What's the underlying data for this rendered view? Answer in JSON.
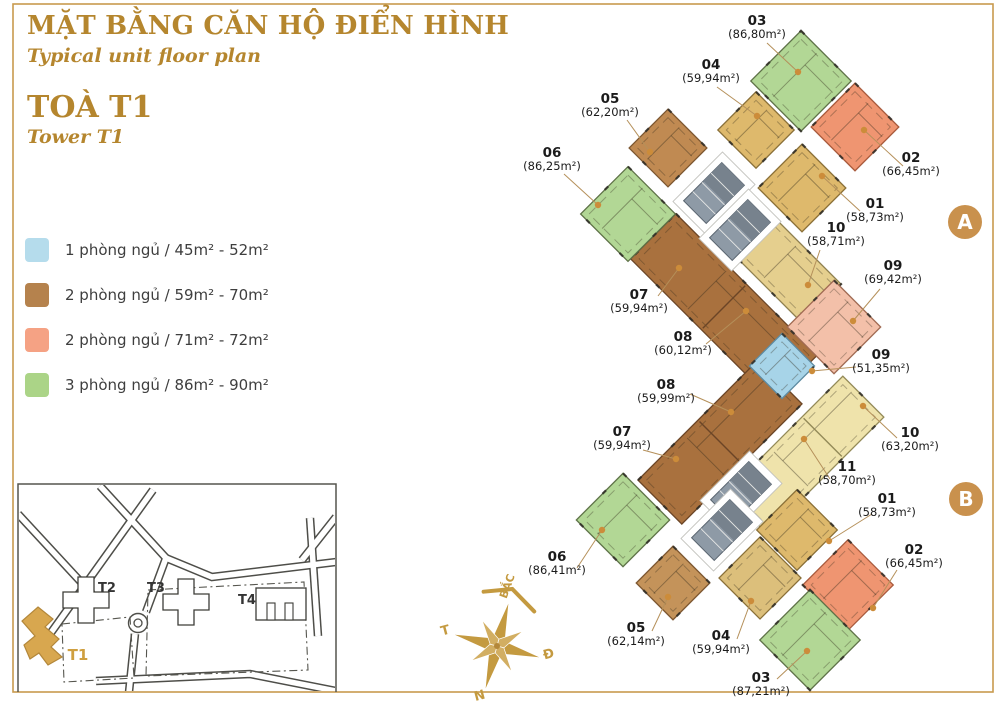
{
  "page": {
    "background": "#ffffff",
    "border_color": "#c89a4e"
  },
  "header": {
    "title_vi": "MẶT BẰNG CĂN HỘ ĐIỂN HÌNH",
    "title_en": "Typical unit floor plan",
    "tower_vi": "TOÀ T1",
    "tower_en": "Tower T1",
    "accent_color": "#b5862e"
  },
  "legend": {
    "items": [
      {
        "color": "#b5dcec",
        "label": "1 phòng ngủ / 45m² - 52m²"
      },
      {
        "color": "#b5824d",
        "label": "2 phòng ngủ / 59m² - 70m²"
      },
      {
        "color": "#f5a284",
        "label": "2 phòng ngủ / 71m² - 72m²"
      },
      {
        "color": "#abd487",
        "label": "3 phòng ngủ / 86m² - 90m²"
      }
    ]
  },
  "site_map": {
    "buildings": [
      {
        "id": "T1",
        "x": 78,
        "y": 660,
        "color": "#cf9f3f",
        "highlight": true
      },
      {
        "id": "T2",
        "x": 107,
        "y": 592,
        "color": "#343434",
        "highlight": false
      },
      {
        "id": "T3",
        "x": 156,
        "y": 592,
        "color": "#343434",
        "highlight": false
      },
      {
        "id": "T4",
        "x": 247,
        "y": 604,
        "color": "#343434",
        "highlight": false
      }
    ]
  },
  "compass": {
    "north": "BẮC",
    "east": "Đ",
    "south": "N",
    "west": "T",
    "color": "#c49a40"
  },
  "plan": {
    "badge_color": "#c9914d",
    "leader_color": "#b5905a",
    "dot_color": "#cc8c3a",
    "badges": [
      {
        "label": "A",
        "x": 965,
        "y": 222
      },
      {
        "label": "B",
        "x": 966,
        "y": 499
      }
    ],
    "shapes": [
      {
        "id": "wing-a-strip-07-08",
        "cx": 724,
        "cy": 307,
        "w": 200,
        "h": 64,
        "rot": 45,
        "fill": "#a9713e",
        "stk": "#6b4526",
        "div": true,
        "divAt": 0
      },
      {
        "id": "wing-b-strip-08-07",
        "cx": 720,
        "cy": 442,
        "w": 170,
        "h": 62,
        "rot": -45,
        "fill": "#a9713e",
        "stk": "#6b4526",
        "div": true,
        "divAt": 0
      },
      {
        "id": "unit-strip-10a",
        "cx": 788,
        "cy": 270,
        "w": 95,
        "h": 55,
        "rot": 45,
        "fill": "#e5cf8e",
        "stk": "#8f8050",
        "div": false,
        "divAt": 0
      },
      {
        "id": "unit-strip-10-11b",
        "cx": 805,
        "cy": 455,
        "w": 165,
        "h": 58,
        "rot": -45,
        "fill": "#efe3ab",
        "stk": "#938a58",
        "div": true,
        "divAt": 25
      },
      {
        "id": "unit-a06",
        "cx": 628,
        "cy": 214,
        "w": 67,
        "h": 67,
        "rot": 45,
        "fill": "#b2d795",
        "stk": "#5e7247",
        "div": false,
        "divAt": 0
      },
      {
        "id": "unit-a05",
        "cx": 668,
        "cy": 148,
        "w": 55,
        "h": 55,
        "rot": 45,
        "fill": "#c08a52",
        "stk": "#7c5630",
        "div": false,
        "divAt": 0
      },
      {
        "id": "unit-a04",
        "cx": 756,
        "cy": 130,
        "w": 54,
        "h": 54,
        "rot": 45,
        "fill": "#deb96c",
        "stk": "#8a7038",
        "div": false,
        "divAt": 0
      },
      {
        "id": "unit-a03",
        "cx": 801,
        "cy": 81,
        "w": 71,
        "h": 71,
        "rot": 45,
        "fill": "#b2d795",
        "stk": "#5e7247",
        "div": false,
        "divAt": 0
      },
      {
        "id": "unit-a02",
        "cx": 855,
        "cy": 127,
        "w": 62,
        "h": 62,
        "rot": 45,
        "fill": "#ef9571",
        "stk": "#a85a3c",
        "div": false,
        "divAt": 0
      },
      {
        "id": "unit-a01",
        "cx": 802,
        "cy": 188,
        "w": 62,
        "h": 62,
        "rot": 45,
        "fill": "#deb96c",
        "stk": "#8a7038",
        "div": false,
        "divAt": 0
      },
      {
        "id": "unit-a09",
        "cx": 834,
        "cy": 327,
        "w": 66,
        "h": 66,
        "rot": 45,
        "fill": "#f3c0a9",
        "stk": "#a06a52",
        "div": false,
        "divAt": 0
      },
      {
        "id": "unit-09-blue",
        "cx": 782,
        "cy": 366,
        "w": 46,
        "h": 46,
        "rot": 45,
        "fill": "#a7d4e8",
        "stk": "#5d8aa0",
        "div": false,
        "divAt": 0
      },
      {
        "id": "unit-b01",
        "cx": 797,
        "cy": 530,
        "w": 57,
        "h": 57,
        "rot": 45,
        "fill": "#deb96c",
        "stk": "#8a7038",
        "div": false,
        "divAt": 0
      },
      {
        "id": "unit-b02",
        "cx": 848,
        "cy": 585,
        "w": 64,
        "h": 64,
        "rot": 45,
        "fill": "#ef9571",
        "stk": "#a85a3c",
        "div": false,
        "divAt": 0
      },
      {
        "id": "unit-b06",
        "cx": 623,
        "cy": 520,
        "w": 66,
        "h": 66,
        "rot": 45,
        "fill": "#b2d795",
        "stk": "#5e7247",
        "div": false,
        "divAt": 0
      },
      {
        "id": "unit-b05",
        "cx": 673,
        "cy": 583,
        "w": 52,
        "h": 52,
        "rot": 45,
        "fill": "#c4935a",
        "stk": "#7c5630",
        "div": false,
        "divAt": 0
      },
      {
        "id": "unit-b04",
        "cx": 760,
        "cy": 578,
        "w": 58,
        "h": 58,
        "rot": 45,
        "fill": "#dcbf7b",
        "stk": "#8a7038",
        "div": false,
        "divAt": 0
      },
      {
        "id": "unit-b03",
        "cx": 810,
        "cy": 640,
        "w": 71,
        "h": 71,
        "rot": 45,
        "fill": "#b2d795",
        "stk": "#5e7247",
        "div": false,
        "divAt": 0
      }
    ],
    "cores": [
      {
        "cx": 714,
        "cy": 193
      },
      {
        "cx": 740,
        "cy": 230
      },
      {
        "cx": 741,
        "cy": 492
      },
      {
        "cx": 722,
        "cy": 530
      }
    ],
    "labels": [
      {
        "id": "a03",
        "no": "03",
        "area": "(86,80m²)",
        "x": 757,
        "y": 25,
        "l": [
          767,
          43,
          798,
          72
        ]
      },
      {
        "id": "a04",
        "no": "04",
        "area": "(59,94m²)",
        "x": 711,
        "y": 69,
        "l": [
          717,
          87,
          757,
          116
        ]
      },
      {
        "id": "a05",
        "no": "05",
        "area": "(62,20m²)",
        "x": 610,
        "y": 103,
        "l": [
          627,
          120,
          650,
          152
        ]
      },
      {
        "id": "a06",
        "no": "06",
        "area": "(86,25m²)",
        "x": 552,
        "y": 157,
        "l": [
          564,
          174,
          598,
          205
        ]
      },
      {
        "id": "a02",
        "no": "02",
        "area": "(66,45m²)",
        "x": 911,
        "y": 162,
        "l": [
          903,
          166,
          864,
          130
        ]
      },
      {
        "id": "a01",
        "no": "01",
        "area": "(58,73m²)",
        "x": 875,
        "y": 208,
        "l": [
          860,
          211,
          822,
          176
        ]
      },
      {
        "id": "a10",
        "no": "10",
        "area": "(58,71m²)",
        "x": 836,
        "y": 232,
        "l": [
          820,
          250,
          808,
          285
        ]
      },
      {
        "id": "a09",
        "no": "09",
        "area": "(69,42m²)",
        "x": 893,
        "y": 270,
        "l": [
          880,
          289,
          853,
          321
        ]
      },
      {
        "id": "a07",
        "no": "07",
        "area": "(59,94m²)",
        "x": 639,
        "y": 299,
        "l": [
          658,
          296,
          679,
          268
        ]
      },
      {
        "id": "a08",
        "no": "08",
        "area": "(60,12m²)",
        "x": 683,
        "y": 341,
        "l": [
          706,
          344,
          746,
          311
        ]
      },
      {
        "id": "m09",
        "no": "09",
        "area": "(51,35m²)",
        "x": 881,
        "y": 359,
        "l": [
          856,
          367,
          812,
          371
        ]
      },
      {
        "id": "b08",
        "no": "08",
        "area": "(59,99m²)",
        "x": 666,
        "y": 389,
        "l": [
          690,
          394,
          731,
          412
        ]
      },
      {
        "id": "b10",
        "no": "10",
        "area": "(63,20m²)",
        "x": 910,
        "y": 437,
        "l": [
          897,
          438,
          863,
          406
        ]
      },
      {
        "id": "b07",
        "no": "07",
        "area": "(59,94m²)",
        "x": 622,
        "y": 436,
        "l": [
          643,
          450,
          676,
          459
        ]
      },
      {
        "id": "b11",
        "no": "11",
        "area": "(58,70m²)",
        "x": 847,
        "y": 471,
        "l": [
          830,
          479,
          804,
          439
        ]
      },
      {
        "id": "b01",
        "no": "01",
        "area": "(58,73m²)",
        "x": 887,
        "y": 503,
        "l": [
          872,
          514,
          829,
          541
        ]
      },
      {
        "id": "b02",
        "no": "02",
        "area": "(66,45m²)",
        "x": 914,
        "y": 554,
        "l": [
          897,
          570,
          873,
          608
        ]
      },
      {
        "id": "b06",
        "no": "06",
        "area": "(86,41m²)",
        "x": 557,
        "y": 561,
        "l": [
          577,
          568,
          602,
          530
        ]
      },
      {
        "id": "b05",
        "no": "05",
        "area": "(62,14m²)",
        "x": 636,
        "y": 632,
        "l": [
          652,
          631,
          668,
          597
        ]
      },
      {
        "id": "b04",
        "no": "04",
        "area": "(59,94m²)",
        "x": 721,
        "y": 640,
        "l": [
          737,
          639,
          751,
          601
        ]
      },
      {
        "id": "b03",
        "no": "03",
        "area": "(87,21m²)",
        "x": 761,
        "y": 682,
        "l": [
          777,
          679,
          807,
          651
        ]
      }
    ]
  }
}
